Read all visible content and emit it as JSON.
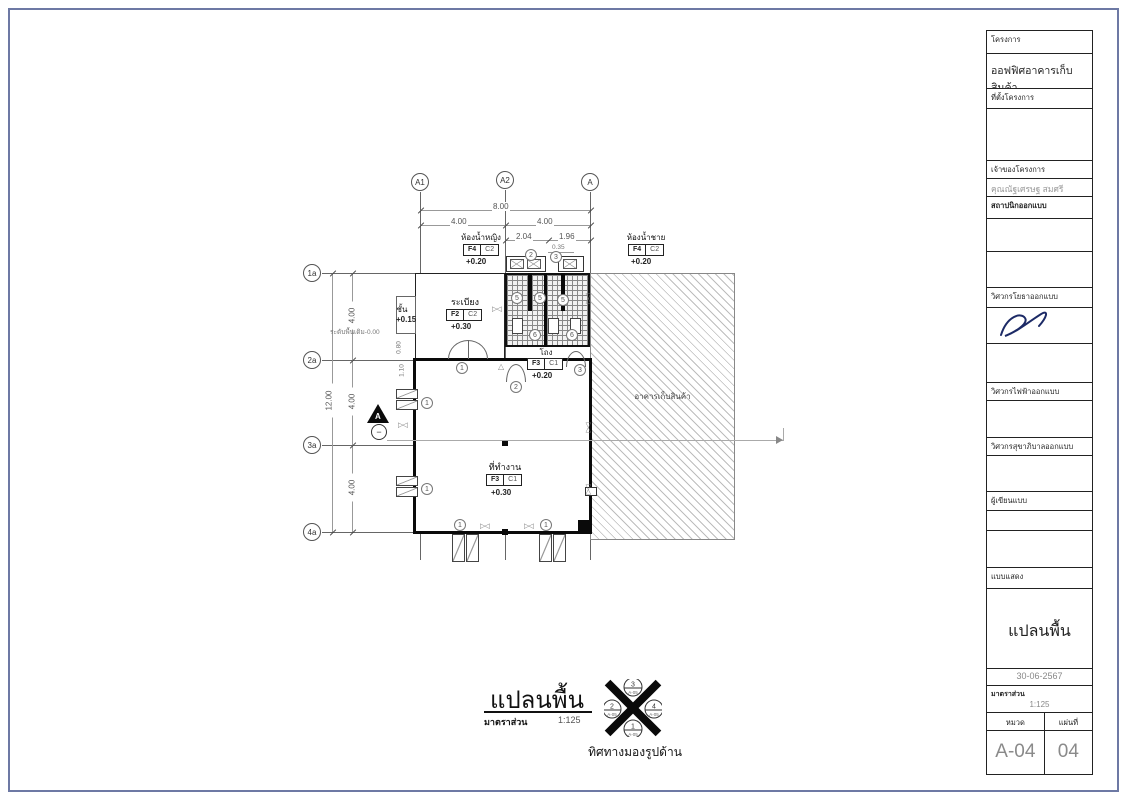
{
  "titleblock": {
    "project_label": "โครงการ",
    "project_name": "ออฟฟิศอาคารเก็บสินค้า",
    "site_label": "ที่ตั้งโครงการ",
    "owner_label": "เจ้าของโครงการ",
    "owner_name": "คุณณัฐเศรษฐ สมศรี",
    "architect_label": "สถาปนิกออกแบบ",
    "civil_label": "วิศวกรโยธาออกแบบ",
    "electrical_label": "วิศวกรไฟฟ้าออกแบบ",
    "sanitary_label": "วิศวกรสุขาภิบาลออกแบบ",
    "draftsman_label": "ผู้เขียนแบบ",
    "shows_label": "แบบแสดง",
    "drawing_title": "แปลนพื้น",
    "date": "30-06-2567",
    "scale_label": "มาตราส่วน",
    "scale_value": "1:125",
    "series_label": "หมวด",
    "sheet_label": "แผ่นที่",
    "series_value": "A-04",
    "sheet_value": "04"
  },
  "plan": {
    "grid_cols": [
      "A1",
      "A2",
      "A"
    ],
    "grid_rows": [
      "1a",
      "2a",
      "3a",
      "4a"
    ],
    "dims": {
      "total_w": "8.00",
      "w": [
        "4.00",
        "4.00"
      ],
      "sub": [
        "2.04",
        "1.96"
      ],
      "total_h": "12.00",
      "h": [
        "4.00",
        "4.00",
        "4.00"
      ],
      "small": [
        "0.35",
        "0.80",
        "1.10"
      ]
    },
    "rooms": {
      "wc_f": {
        "name": "ห้องน้ำหญิง",
        "tag1": "F4",
        "tag2": "C2",
        "level": "+0.20"
      },
      "wc_m": {
        "name": "ห้องน้ำชาย",
        "tag1": "F4",
        "tag2": "C2",
        "level": "+0.20"
      },
      "terrace": {
        "name": "ระเบียง",
        "tag1": "F2",
        "tag2": "C2",
        "level": "+0.30"
      },
      "hall": {
        "name": "โถง",
        "tag1": "F3",
        "tag2": "C1",
        "level": "+0.20"
      },
      "work": {
        "name": "ที่ทำงาน",
        "tag1": "F3",
        "tag2": "C1",
        "level": "+0.30"
      }
    },
    "step_label": "ชั้น",
    "step_level": "+0.15",
    "ground_note": "ระดับพื้นเดิม-0.00",
    "existing_label": "อาคารเก็บสินค้า",
    "section": {
      "letter": "A",
      "sign": "−"
    },
    "tags": {
      "n1": "1",
      "n2": "2",
      "n3": "3",
      "n5": "5",
      "n6": "6",
      "win": "1"
    },
    "bowtie": "▷◁",
    "keytri": "△"
  },
  "footer": {
    "title": "แปลนพื้น",
    "scale_label": "มาตราส่วน",
    "scale_value": "1:125",
    "view_label": "ทิศทางมองรูปด้าน",
    "compass": {
      "top": "3",
      "left": "2",
      "right": "4",
      "bottom": "1",
      "ref": "A-05"
    }
  }
}
